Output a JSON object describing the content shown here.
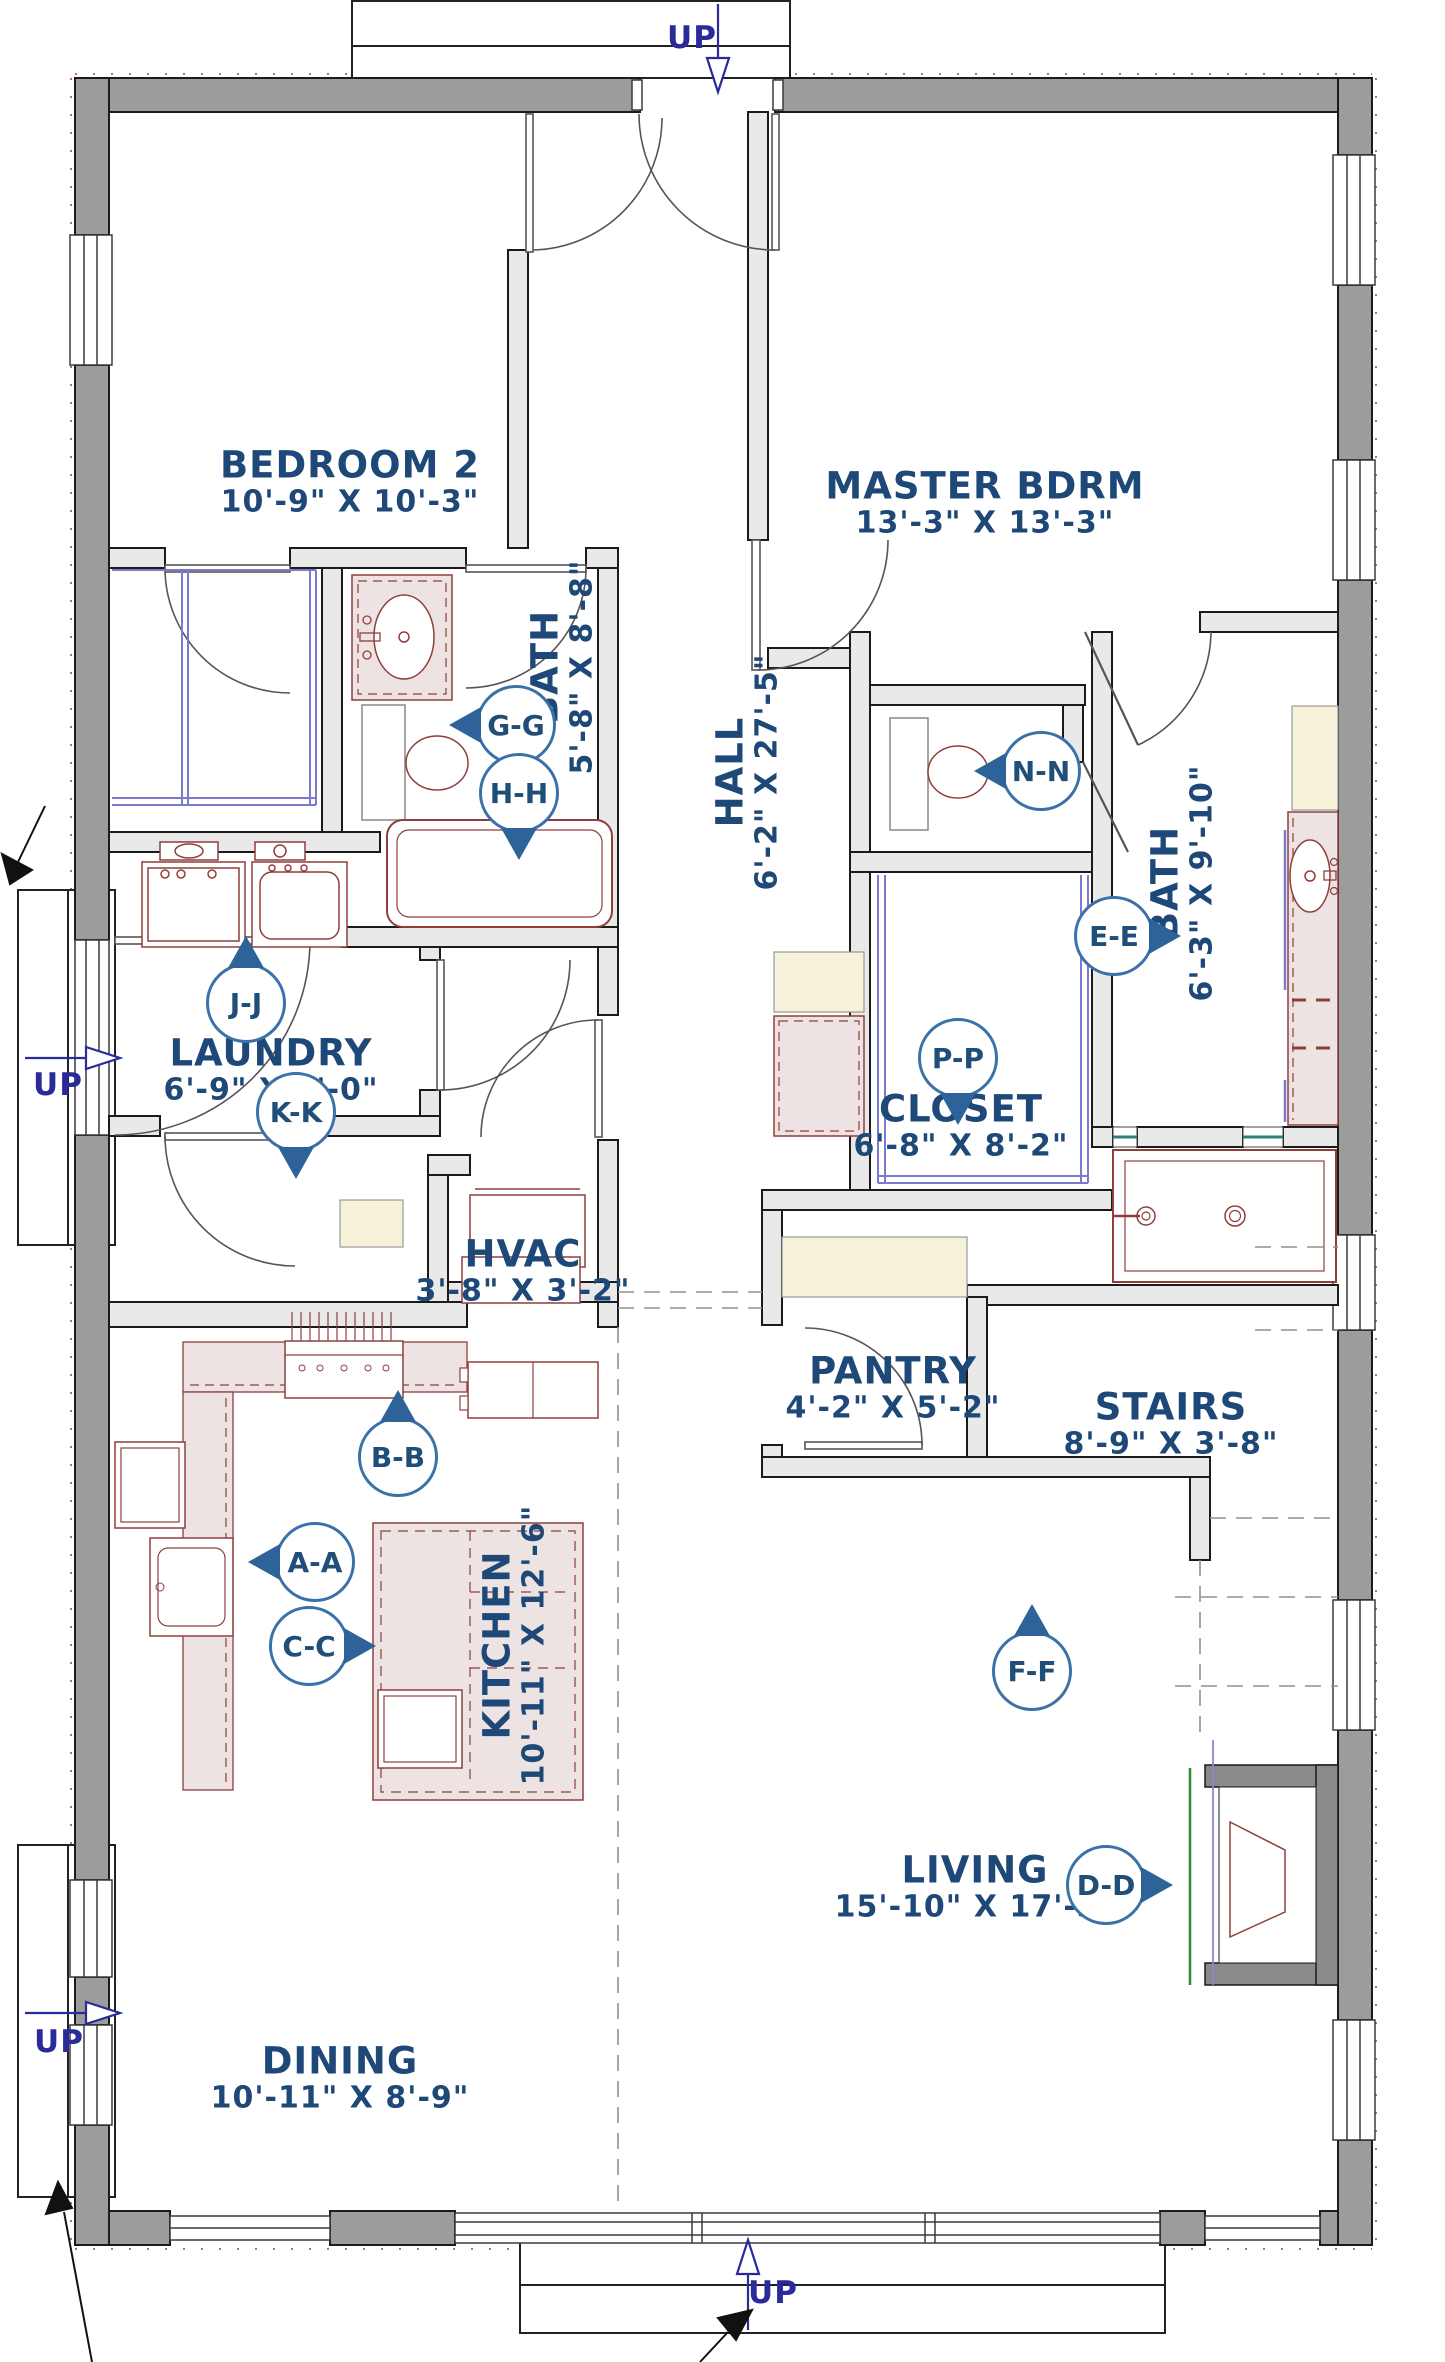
{
  "colors": {
    "label_blue": "#1e4878",
    "marker_ring_blue": "#3a71a8",
    "marker_arrow_blue": "#2e6399",
    "exterior_wall_gray": "#9c9c9c",
    "interior_wall_gray": "#e9e9e9",
    "fixture_red": "#8e3f3c",
    "cabinet_pink": "#ede3e2",
    "cabinet_cream": "#f6f2da",
    "shelf_blue": "#7a7ace",
    "up_arrow_navy": "#2a2a9a",
    "hearth_green": "#2e8b2e"
  },
  "up_label": "UP",
  "rooms": [
    {
      "id": "bedroom-2",
      "name": "BEDROOM 2",
      "dims": "10'-9\" X 10'-3\""
    },
    {
      "id": "master-bdrm",
      "name": "MASTER BDRM",
      "dims": "13'-3\" X 13'-3\""
    },
    {
      "id": "hall-bath",
      "name": "BATH",
      "dims": "5'-8\" X 8'-8\""
    },
    {
      "id": "hall",
      "name": "HALL",
      "dims": "6'-2\" X 27'-5\""
    },
    {
      "id": "master-bath",
      "name": "BATH",
      "dims": "6'-3\" X 9'-10\""
    },
    {
      "id": "laundry",
      "name": "LAUNDRY",
      "dims": "6'-9\" X 8'-0\""
    },
    {
      "id": "closet",
      "name": "CLOSET",
      "dims": "6'-8\" X 8'-2\""
    },
    {
      "id": "hvac",
      "name": "HVAC",
      "dims": "3'-8\" X 3'-2\""
    },
    {
      "id": "pantry",
      "name": "PANTRY",
      "dims": "4'-2\" X 5'-2\""
    },
    {
      "id": "stairs",
      "name": "STAIRS",
      "dims": "8'-9\" X 3'-8\""
    },
    {
      "id": "kitchen",
      "name": "KITCHEN",
      "dims": "10'-11\" X 12'-6\""
    },
    {
      "id": "living",
      "name": "LIVING",
      "dims": "15'-10\" X 17'-3\""
    },
    {
      "id": "dining",
      "name": "DINING",
      "dims": "10'-11\" X 8'-9\""
    }
  ],
  "markers": [
    {
      "label": "G-G"
    },
    {
      "label": "H-H"
    },
    {
      "label": "J-J"
    },
    {
      "label": "K-K"
    },
    {
      "label": "N-N"
    },
    {
      "label": "E-E"
    },
    {
      "label": "P-P"
    },
    {
      "label": "B-B"
    },
    {
      "label": "A-A"
    },
    {
      "label": "C-C"
    },
    {
      "label": "F-F"
    },
    {
      "label": "D-D"
    }
  ]
}
